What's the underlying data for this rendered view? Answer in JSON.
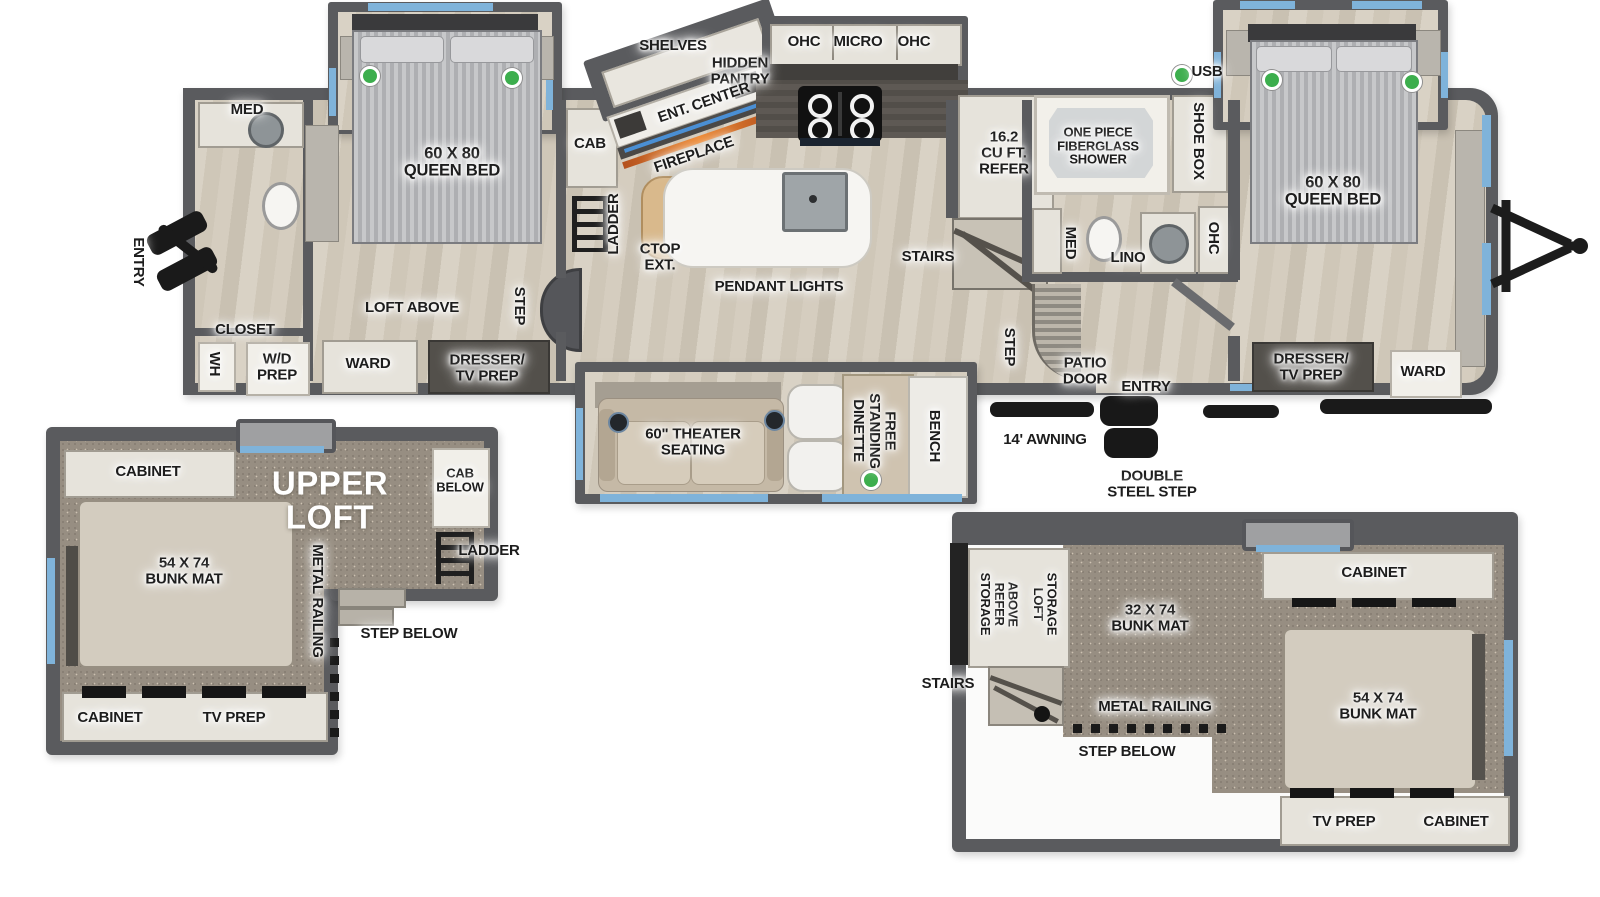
{
  "colors": {
    "wall": "#5a5b5e",
    "floor_wood": "#d4ccbe",
    "carpet": "#978e82",
    "window_blue": "#7fb3da",
    "indicator_green": "#3cae4d",
    "label_text": "#1d1d1d",
    "fireplace_orange": "#e0762e"
  },
  "main": {
    "rear_bath": {
      "med": "MED",
      "entry": "ENTRY",
      "closet": "CLOSET",
      "wh": "WH",
      "wd_prep": "W/D\nPREP"
    },
    "bedroom2": {
      "queen_bed": "60 X 80\nQUEEN BED",
      "cab": "CAB",
      "ladder": "LADDER",
      "loft_above": "LOFT ABOVE",
      "ward": "WARD",
      "dresser_tv": "DRESSER/\nTV PREP",
      "step": "STEP"
    },
    "living": {
      "shelves": "SHELVES",
      "hidden_pantry": "HIDDEN\nPANTRY",
      "ent_center": "ENT. CENTER",
      "fireplace": "FIREPLACE",
      "ctop_ext": "CTOP\nEXT.",
      "pendant_lights": "PENDANT LIGHTS"
    },
    "kitchen": {
      "ohc_left": "OHC",
      "micro": "MICRO",
      "ohc_right": "OHC",
      "refer": "16.2\nCU FT.\nREFER",
      "stairs": "STAIRS"
    },
    "mid_bath": {
      "shower": "ONE PIECE\nFIBERGLASS\nSHOWER",
      "shoe_box": "SHOE BOX",
      "med": "MED",
      "lino": "LINO",
      "ohc": "OHC"
    },
    "front_bedroom": {
      "usb": "USB",
      "queen_bed": "60 X 80\nQUEEN BED",
      "dresser_tv": "DRESSER/\nTV PREP",
      "ward": "WARD"
    },
    "exterior": {
      "step": "STEP",
      "patio_door": "PATIO\nDOOR",
      "entry": "ENTRY",
      "awning": "14' AWNING",
      "double_step": "DOUBLE\nSTEEL STEP"
    },
    "bottom_slide": {
      "theater": "60\" THEATER\nSEATING",
      "dinette": "FREE\nSTANDING\nDINETTE",
      "bench": "BENCH"
    }
  },
  "upper_loft": {
    "title": "UPPER\nLOFT",
    "cabinet_top": "CABINET",
    "cab_below": "CAB\nBELOW",
    "bunk": "54 X 74\nBUNK MAT",
    "ladder": "LADDER",
    "metal_railing": "METAL RAILING",
    "step_below": "STEP BELOW",
    "cabinet_bottom": "CABINET",
    "tv_prep": "TV PREP"
  },
  "rear_loft": {
    "above_refer_storage": "ABOVE\nREFER\nSTORAGE",
    "loft_storage": "LOFT\nSTORAGE",
    "stairs": "STAIRS",
    "bunk_32": "32 X 74\nBUNK MAT",
    "cabinet_top": "CABINET",
    "metal_railing": "METAL RAILING",
    "step_below": "STEP BELOW",
    "bunk_54": "54 X 74\nBUNK MAT",
    "tv_prep": "TV PREP",
    "cabinet_bottom": "CABINET"
  }
}
